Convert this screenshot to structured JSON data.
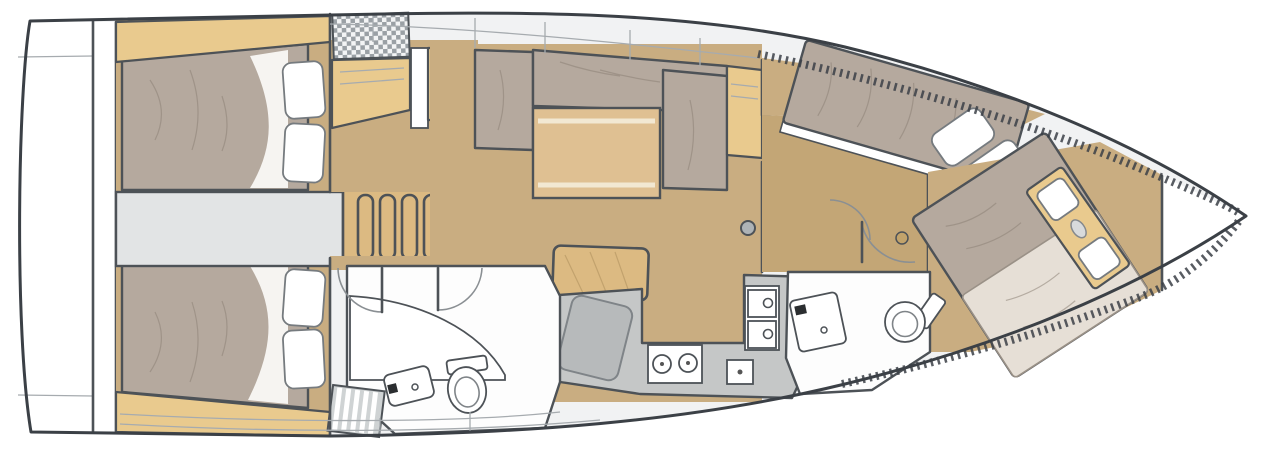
{
  "diagram": {
    "type": "yacht-interior-floor-plan",
    "orientation": "bow-right-stern-left",
    "text_labels": [],
    "areas": [
      {
        "id": "transom",
        "name": "stern-swim-platform"
      },
      {
        "id": "aft-cabin-port",
        "name": "aft-double-cabin-port"
      },
      {
        "id": "aft-cabin-starboard",
        "name": "aft-double-cabin-starboard"
      },
      {
        "id": "engine-compartment",
        "name": "engine-compartment"
      },
      {
        "id": "companionway",
        "name": "companionway-steps"
      },
      {
        "id": "nav-area",
        "name": "chart-table-area"
      },
      {
        "id": "salon",
        "name": "salon-with-l-settee-and-table"
      },
      {
        "id": "galley",
        "name": "galley-with-stove-and-sink"
      },
      {
        "id": "head-aft",
        "name": "aft-bathroom-with-toilet-and-vanity"
      },
      {
        "id": "corridor-fwd",
        "name": "forward-passageway"
      },
      {
        "id": "fwd-cabin-port",
        "name": "forward-cabin-port-berth"
      },
      {
        "id": "fwd-cabin-starboard",
        "name": "forward-cabin-starboard-berth"
      },
      {
        "id": "head-fwd",
        "name": "forward-bathroom-with-toilet-and-vanity"
      },
      {
        "id": "bow-locker",
        "name": "bow-anchor-locker"
      }
    ],
    "fixtures": [
      "bed-mattress",
      "pillows",
      "headboard-shelf",
      "dining-table",
      "l-settee",
      "bench-stool",
      "two-burner-stove",
      "double-sink",
      "toilet",
      "vanity-sink",
      "shower-grate",
      "mast-post",
      "door-swing-arc",
      "hatch-grate",
      "toe-rail-hatching"
    ]
  },
  "colors": {
    "hullStroke": "#3b4046",
    "wall": "#4d5257",
    "deck": "#f1f2f3",
    "floor": "#c9ad81",
    "corridorFloor": "#c3a676",
    "shelfWood": "#e9ca8e",
    "tableWood": "#dfc092",
    "stepsWood": "#dcba82",
    "mattress": "#b5a99e",
    "duvet": "#e6dfd6",
    "counter": "#c5c7c7",
    "seam": "#a6abaf",
    "wrinkle": "#8d8277"
  }
}
